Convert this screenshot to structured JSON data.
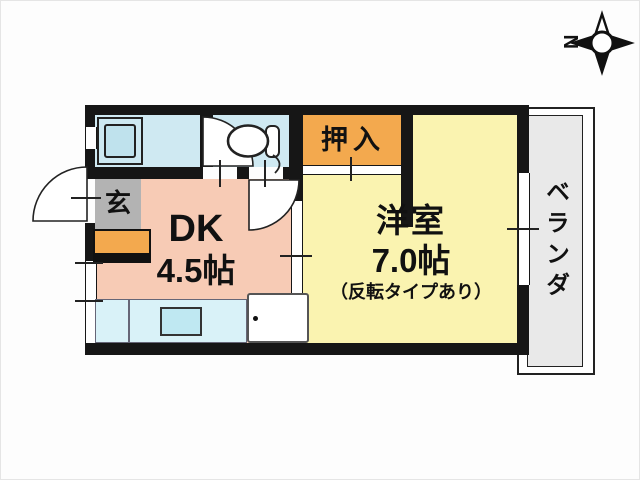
{
  "title": "floor-plan",
  "compass": {
    "north_label": "N",
    "direction": "left"
  },
  "rooms": {
    "dk": {
      "name": "DK",
      "size": "4.5帖",
      "color": "#f7cbb5"
    },
    "western": {
      "name": "洋室",
      "size": "7.0帖",
      "note": "（反転タイプあり）",
      "color": "#faf3b0"
    },
    "closet": {
      "label": "押入",
      "color": "#f3a94e"
    },
    "entrance": {
      "label": "玄",
      "color": "#b3b3b3"
    },
    "veranda": {
      "label": "ベランダ",
      "color": "#e9e9e9"
    },
    "bathroom": {
      "color": "#cfe9f2"
    },
    "toilet": {
      "color": "#cfe9f2"
    }
  },
  "fixtures": {
    "bathtub": "bathtub",
    "toilet": "toilet",
    "kitchen_counter": "kitchen-counter-with-sink",
    "appliance": "refrigerator-space",
    "shoe_cabinet": "shoe-cabinet"
  },
  "palette": {
    "wall": "#161616",
    "counter": "#d9f2f8",
    "sink": "#bfe8f2",
    "bathtub_outer": "#cde9f2",
    "bathtub_inner": "#bfe2ed",
    "background": "#fdfdfd"
  }
}
